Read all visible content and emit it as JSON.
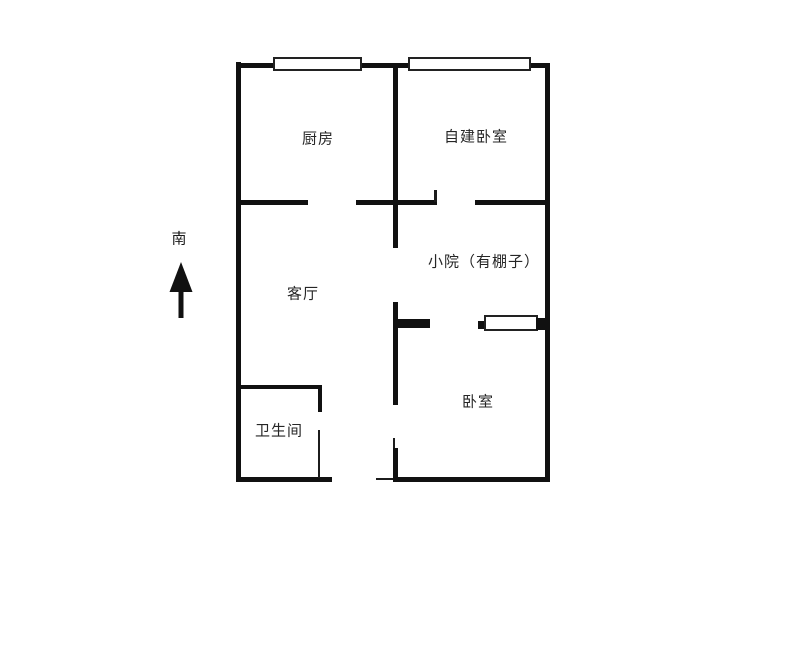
{
  "canvas": {
    "background": "#ffffff",
    "wall_color": "#111111",
    "label_color": "#262626",
    "window_border": "#222222"
  },
  "compass": {
    "label": "南",
    "arrow_icon": "arrow-up"
  },
  "rooms": {
    "kitchen": {
      "label": "厨房"
    },
    "self_built_bedroom": {
      "label": "自建卧室"
    },
    "courtyard": {
      "label": "小院（有棚子）"
    },
    "living_room": {
      "label": "客厅"
    },
    "bathroom": {
      "label": "卫生间"
    },
    "bedroom": {
      "label": "卧室"
    }
  }
}
